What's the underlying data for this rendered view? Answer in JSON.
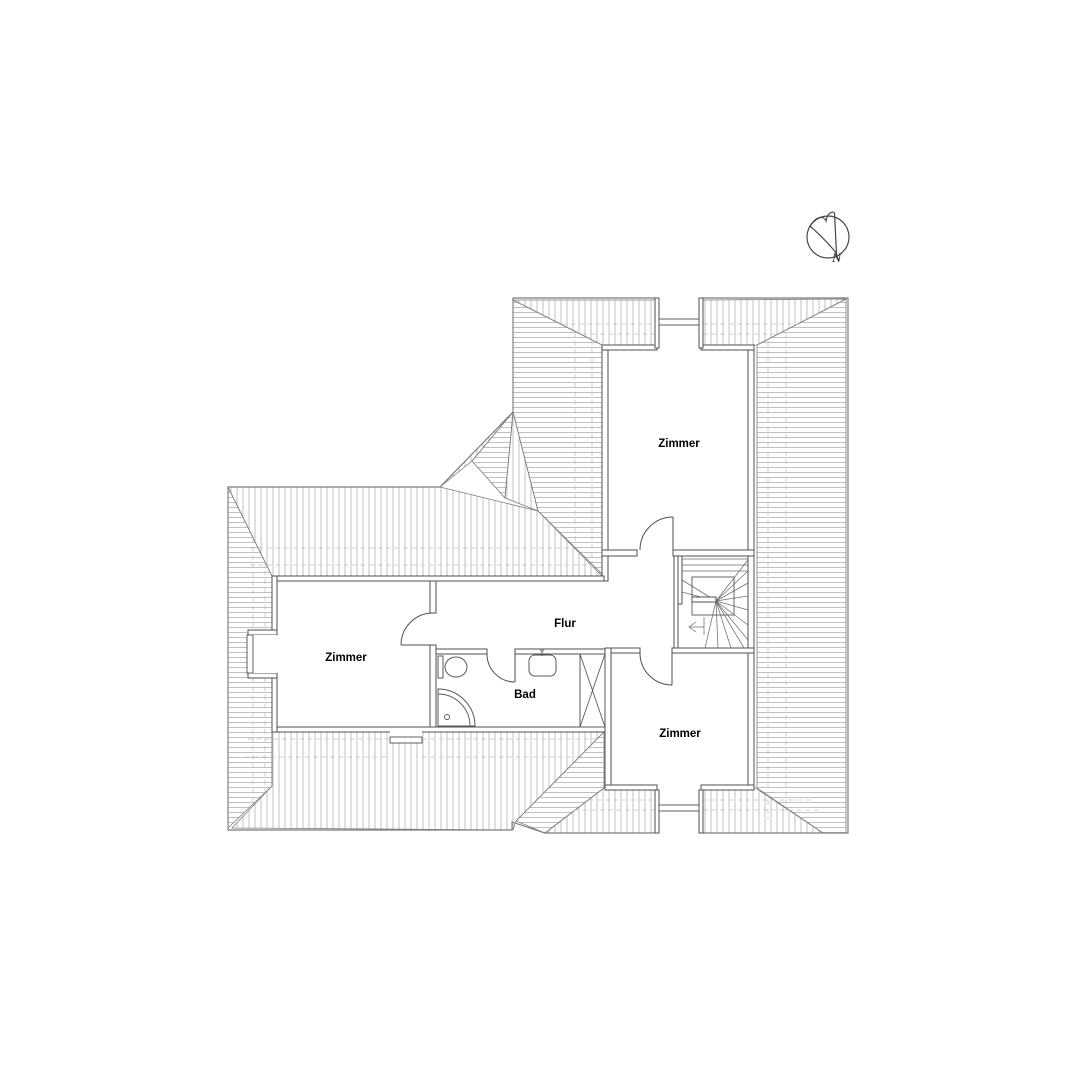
{
  "floorplan": {
    "type": "attic-floor-plan",
    "rooms": [
      {
        "id": "room-top",
        "label": "Zimmer"
      },
      {
        "id": "room-left",
        "label": "Zimmer"
      },
      {
        "id": "room-bottom",
        "label": "Zimmer"
      },
      {
        "id": "hallway",
        "label": "Flur"
      },
      {
        "id": "bathroom",
        "label": "Bad"
      }
    ],
    "compass": {
      "label": "N"
    },
    "colors": {
      "wall": "#4f4f4f",
      "outline": "#7c7c7c",
      "hatch": "#b0b0b0",
      "dash": "#c1c1c1",
      "text": "#000000",
      "background": "#ffffff"
    }
  }
}
